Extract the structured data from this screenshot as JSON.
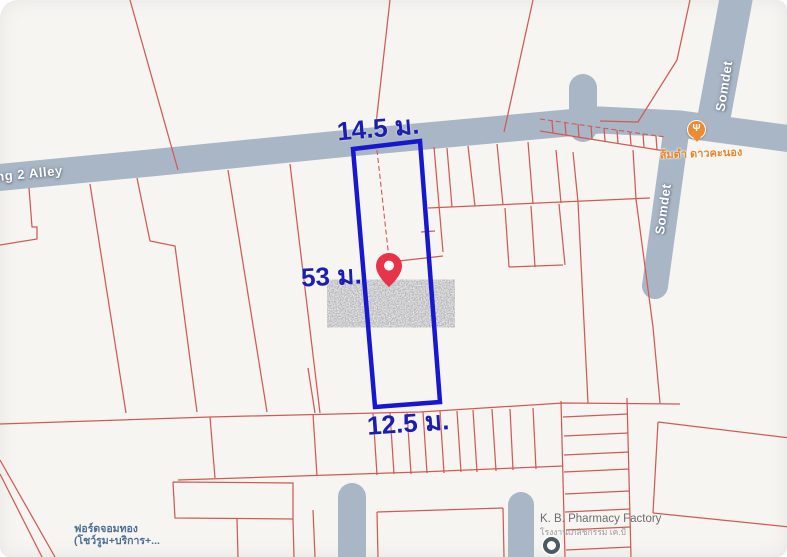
{
  "window": {
    "description": "Map screenshot of land plot for sale with cadastral parcel overlay"
  },
  "labels": {
    "alley_road": "ng 2 Alley",
    "somdet_road_upper": "Somdet",
    "somdet_road_lower": "Somdet",
    "dimension_top": "14.5 ม.",
    "dimension_left": "53 ม.",
    "dimension_bottom": "12.5 ม.",
    "restaurant": {
      "name": "ส้มตำ ดาวคะนอง"
    },
    "pharmacy": {
      "name": "K. B. Pharmacy Factory",
      "sub": "โรงงานเภสัชกรรม เค.บี"
    },
    "ford": {
      "line1": "ฟอร์ดจอมทอง",
      "line2": "(โชว์รูม+บริการ+..."
    }
  },
  "icons": {
    "restaurant_glyph": "Ψ"
  },
  "map": {
    "size": {
      "width": 787,
      "height": 557
    },
    "colors": {
      "background": "#f6f5f2",
      "road": "#a9b6c5",
      "parcel_line": "#d25a55",
      "highlight": "#1717cf",
      "dimension_text": "#1c1eb0",
      "pin": "#e8344b",
      "restaurant_orange": "#ef8a2f",
      "business_blue": "#4c6f94",
      "poi_gray": "#6d6d6d"
    },
    "roads": [
      {
        "name": "alley",
        "points": "-6,178 150,163 350,143 600,120 680,124 792,139",
        "width": 27,
        "cap": "butt"
      },
      {
        "name": "somdet-upper",
        "points": "737,-6 712,128",
        "width": 33,
        "cap": "butt"
      },
      {
        "name": "somdet-lower",
        "points": "676,133 655,286",
        "width": 26,
        "cap": "round"
      },
      {
        "name": "alley-stub-north",
        "points": "583,128 583,88",
        "width": 28,
        "cap": "round"
      },
      {
        "name": "dead-end-south-1",
        "points": "352,562 352,497",
        "width": 28,
        "cap": "round"
      },
      {
        "name": "dead-end-south-2",
        "points": "521,562 521,505",
        "width": 26,
        "cap": "round"
      }
    ],
    "solid_lines": [
      "130,0 178,170",
      "390,0 376,124",
      "533,0 504,132",
      "690,0 677,60 638,122 600,121",
      "29,188 32,227 37,227 37,239 0,245",
      "90,184 126,413",
      "137,178 150,241 175,246 197,412",
      "228,170 267,412",
      "290,164 320,413",
      "434,147 443,252",
      "390,262 443,256",
      "421,232 435,231",
      "540,131 665,151",
      "552,121 553,133",
      "565,123 566,135",
      "578,124 579,137",
      "591,126 592,139",
      "604,128 605,141",
      "617,130 618,143",
      "630,132 631,145",
      "643,134 644,147",
      "656,136 657,150",
      "428,208 650,198",
      "447,148 452,207",
      "468,146 475,206",
      "497,144 503,205",
      "528,142 533,204",
      "556,150 561,203",
      "573,152 578,202",
      "633,150 636,199",
      "505,208 509,267",
      "531,206 535,267",
      "509,267 563,265",
      "559,204 565,265",
      "578,202 588,403",
      "636,199 653,327 660,403",
      "308,368 315,413",
      "0,424 210,417 420,412 563,403 680,404",
      "178,480 420,472 563,466",
      "210,417 215,478",
      "313,414 317,476",
      "373,413 377,475",
      "390,413 394,474",
      "407,412 411,474",
      "423,412 427,473",
      "440,411 444,473",
      "457,411 461,472",
      "473,410 477,472",
      "492,409 496,471",
      "510,409 513,470",
      "533,408 536,469",
      "561,401 565,557",
      "627,398 631,557",
      "563,417 628,414",
      "564,436 628,433",
      "564,455 629,452",
      "564,472 629,469",
      "565,494 629,491",
      "565,512 630,509",
      "566,530 630,527",
      "566,550 631,547",
      "658,422 790,438",
      "658,422 653,513",
      "653,513 790,527",
      "173,482 293,483 293,519 175,518 173,482",
      "237,519 238,557",
      "293,519 294,557",
      "377,512 503,508",
      "377,512 378,557",
      "503,508 504,557",
      "313,510 315,557",
      "0,460 55,557",
      "0,474 42,557"
    ],
    "dashed_lines": [
      "377,150 390,268",
      "540,119 665,137"
    ],
    "highlight_parcel": {
      "points": "353,149 420,141 440,402 375,407",
      "stroke_width": 4.5,
      "dimensions": {
        "top": "14.5 ม.",
        "left": "53 ม.",
        "bottom": "12.5 ม."
      }
    },
    "pin": {
      "x": 389,
      "y": 287
    },
    "watermark": {
      "x": 333,
      "y": 282,
      "width": 116,
      "height": 43
    }
  }
}
